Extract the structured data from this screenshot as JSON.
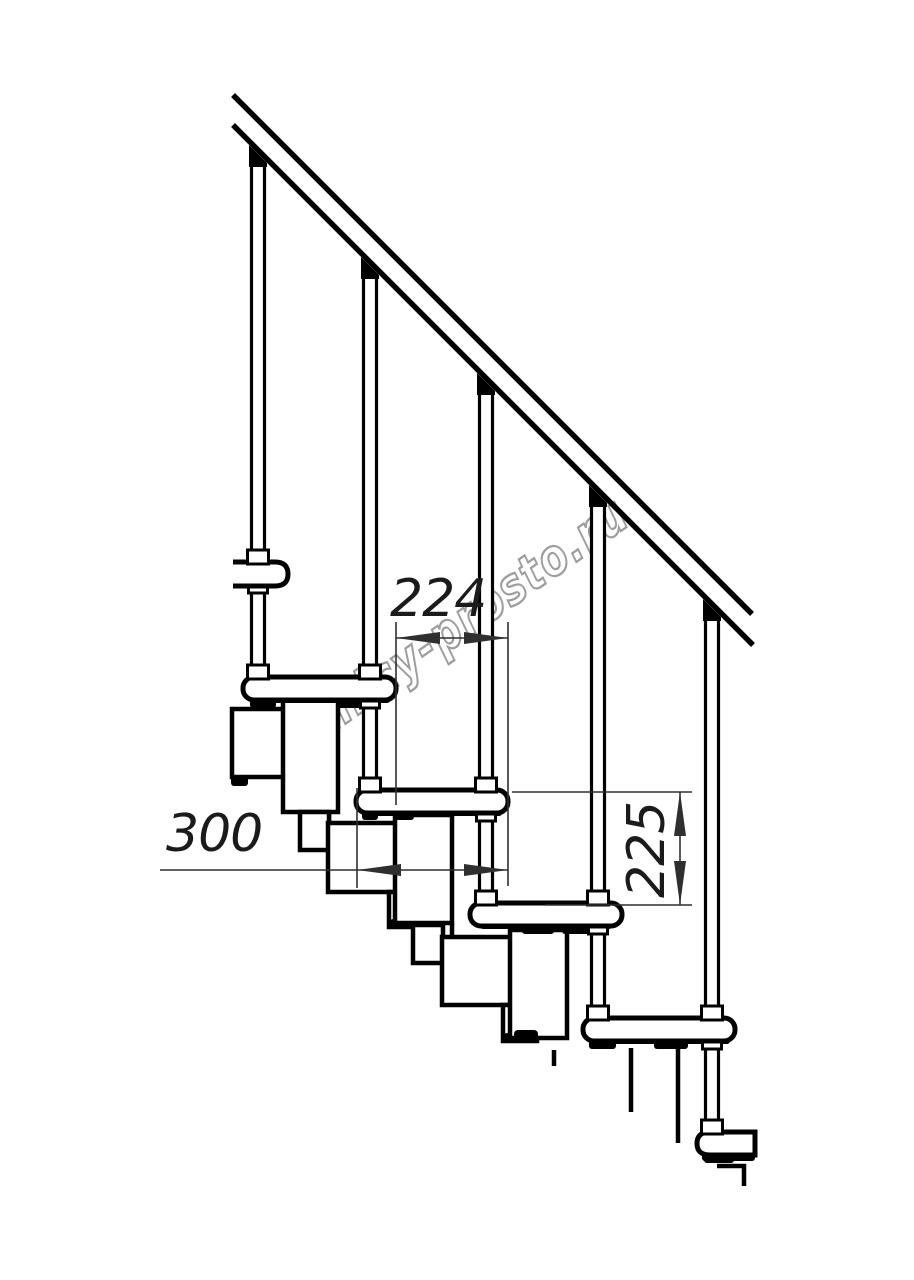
{
  "drawing": {
    "type": "modular-staircase-side-view-technical-drawing",
    "dimension_labels": {
      "step_run": "224",
      "tread_depth": "300",
      "step_rise": "225"
    },
    "watermark_text": "lestnicy-prosto.ru",
    "colors": {
      "background": "#ffffff",
      "linework": "#000000",
      "dimension": "#2f2f2f",
      "watermark_outline": "#9e9e9e"
    }
  }
}
